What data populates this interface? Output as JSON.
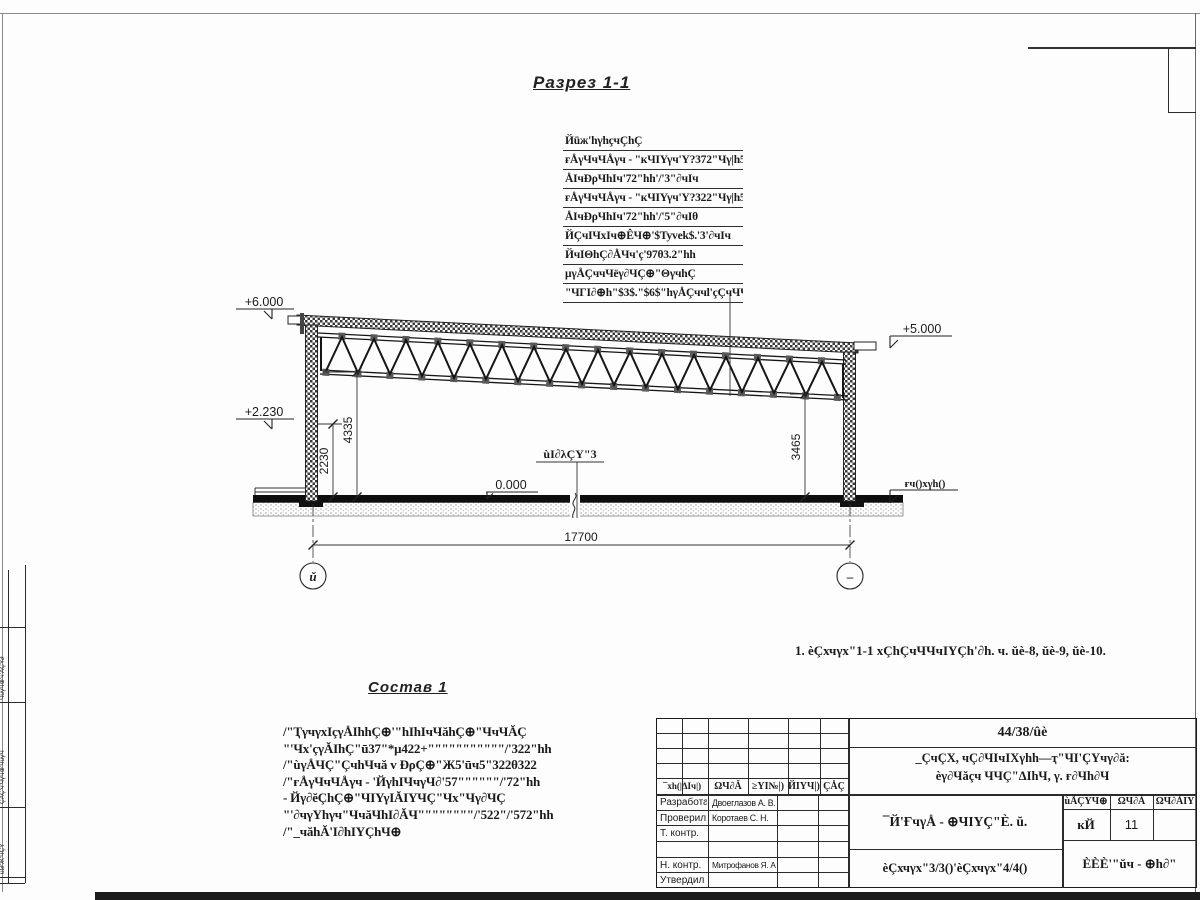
{
  "title": "Разрез 1-1",
  "roof_callout": {
    "lines": [
      "Йūж'hγhçчÇhÇ",
      "ғÅγЧчЧÅγч - \"кЧIΥγч'Υ?372\"Чγ|h5.",
      "ÅIчÐρЧhIч'72\"hh'/'3\"∂чIч",
      "ғÅγЧчЧÅγч - \"кЧIΥγч'Υ?322\"Чγ|h5.",
      "ÅIчÐρЧhIч'72\"hh'/'5\"∂чIθ",
      "ЙÇчIЧхIч⊕ÊЧ⊕'$Tyvek$.'3'∂чIч",
      "ЙчIΘhÇ∂ÅЧч'ç'97θ3.2\"hh",
      "μγÅÇччЧëγ∂ЧÇ⊕\"ΘγчhÇ",
      "\"ЧГI∂⊕h\"$3$.\"$6$\"hγÅÇччl'çÇчЧЧ+"
    ]
  },
  "elevations": {
    "ridge": "+6.000",
    "level": "+2.230",
    "eaves": "+5.000",
    "floor": "0.000",
    "ground": "ғч()хγh()"
  },
  "node_ref": "ùΙ∂λÇΥ\"3",
  "dimensions": {
    "left_inner": "2230",
    "left_outer": "4335",
    "right": "3465",
    "span": "17700"
  },
  "axes": {
    "left": "ǔ",
    "right": "–"
  },
  "note": "1. èÇхчγх\"1-1 хÇhÇчЧЧчIΥÇh'∂h. ч. ŭè-8, ŭè-9, ŭè-10.",
  "composition": {
    "heading": "Состав 1",
    "lines": [
      "/\"ҬγчγхIçγÅIhhÇ⊕'\"hIhIчЧăhÇ⊕\"ЧчЧĂÇ",
      "\"'Чх'çγĂIhÇ\"ū37\"*μ422+\"\"\"\"\"\"\"\"\"\"\"/'322\"hh",
      "/\"ùγÅЧÇ\"ÇчhЧчă v ÐρÇ⊕\"Ж5'ūч5\"322θ322",
      "/\"ғÅγЧчЧÅγч - 'ЙγhIЧчγЧ∂'57\"\"\"\"\"\"/'72\"hh",
      "- Йγ∂ĕÇhÇ⊕\"ЧIΥγIĂIΥЧÇ\"Чх\"Чγ∂ЧÇ",
      "\"'∂чγΥhγч\"ЧчăЧhI∂ĂЧ\"\"\"\"\"\"\"\"/'522\"/'572\"hh",
      "/\"_чăhĂ'I∂hIΥÇhЧ⊕"
    ]
  },
  "title_block": {
    "doc_number": "44/38/ûè",
    "project_line1": "_ÇчÇХ, чÇ∂ЧIчIХγhh—ҭ\"ЧI'ÇYчγ∂ă:",
    "project_line2": "èγ∂Чăçч ЧЧÇ\"ΔIhЧ, γ. ғ∂Чh∂Ч",
    "sheet_title": "¯Й'ҒчγÅ - ⊕ЧIΥÇ\"È. ŭ.",
    "sections_ref": "èÇхчγх\"3/3()'èÇхчγх\"4/4()",
    "org": "ÈÈÈ'\"ŭч - ⊕h∂\"",
    "header_cols": [
      "¯хh(|ΔIч|)",
      "ΩЧ∂Ǎ",
      "≥ΥI№|)",
      "ЙIΥЧ|)",
      "ÇÅÇ"
    ],
    "stage_cols": [
      "ùÅÇΥЧ⊕",
      "ΩЧ∂Ǎ",
      "ΩЧ∂ǍIΥ"
    ],
    "stage_values": [
      "кЙ",
      "11",
      ""
    ],
    "roles": [
      {
        "label": "Разработал",
        "name": "Двоеглазов А. В."
      },
      {
        "label": "Проверил",
        "name": "Коротаев С. Н."
      },
      {
        "label": "Т. контр.",
        "name": ""
      },
      {
        "label": "",
        "name": ""
      },
      {
        "label": "Н. контр.",
        "name": "Митрофанов Я. А."
      },
      {
        "label": "Утвердил",
        "name": ""
      }
    ]
  },
  "side_strip": {
    "cells": [
      "ЧŭγЧ⊕'ч'ÅÇΥ∂",
      "ÇÅÇ'ч'ЧγЧ⊕'ЧŭγЧ",
      "ùΙ∂'Ж'ЧÇΥ"
    ]
  }
}
